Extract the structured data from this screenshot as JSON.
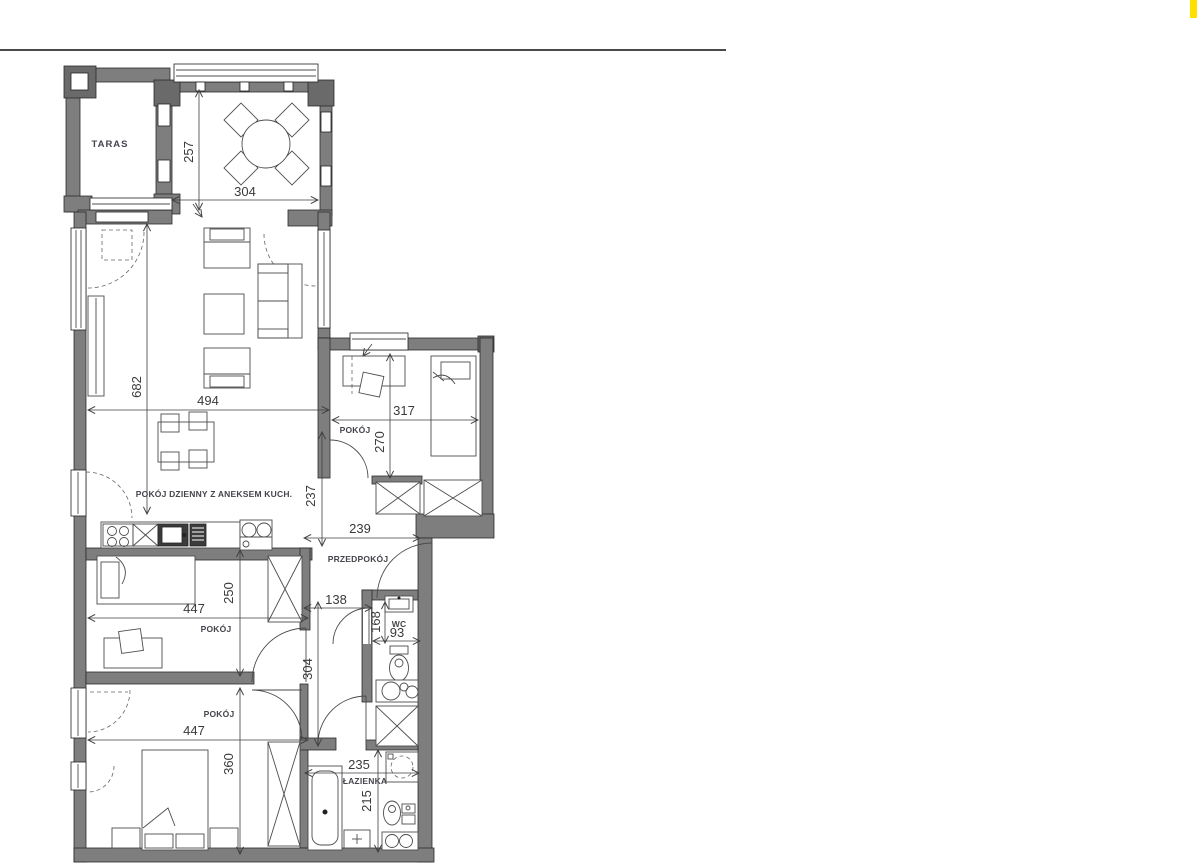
{
  "colors": {
    "rule-color": "#4a4a4d",
    "highlight-color": "#ffe100",
    "wall-color": "#7e7e7e",
    "line-color": "#3f3f3f"
  },
  "floorplan": {
    "labels": {
      "taras": "TARAS",
      "living": "POKÓJ DZIENNY Z ANEKSEM KUCH.",
      "bedroom_top": "POKÓJ",
      "hall": "PRZEDPOKÓJ",
      "wc": "WC",
      "bedroom_mid": "POKÓJ",
      "bedroom_bottom": "POKÓJ",
      "bathroom": "ŁAZIENKA"
    },
    "dimensions": {
      "dining_h": "257",
      "dining_w": "304",
      "living_h": "682",
      "living_w": "494",
      "bedroom_top_w": "317",
      "bedroom_top_h": "270",
      "hall_h": "237",
      "hall_w": "239",
      "corridor_w": "138",
      "wc_h": "168",
      "wc_w": "93",
      "bedroom_mid_h": "250",
      "bedroom_mid_w": "447",
      "corridor_h": "304",
      "bedroom_bottom_w": "447",
      "bedroom_bottom_h": "360",
      "bath_w": "235",
      "bath_h": "215"
    }
  }
}
